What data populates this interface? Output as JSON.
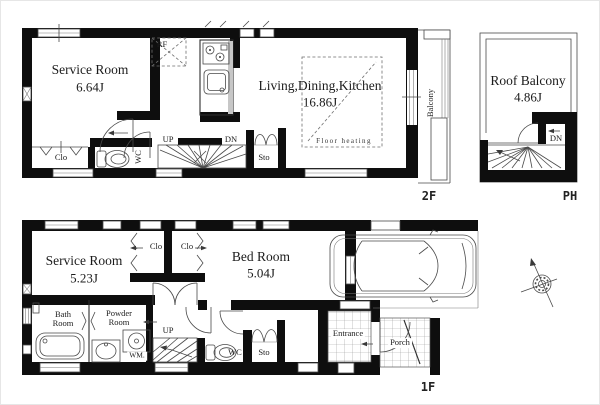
{
  "colors": {
    "wall": "#0e0e0e",
    "line": "#2e2e2e",
    "text": "#1b1b1b",
    "bg": "#ffffff"
  },
  "f2": {
    "floor_label": "2F",
    "service_room": {
      "name": "Service Room",
      "area": "6.64J"
    },
    "ldk": {
      "name": "Living,Dining,Kitchen",
      "area": "16.86J"
    },
    "floor_heating_label": "Floor heating",
    "balcony_label": "Balcony",
    "fridge_label": "RF",
    "closet_label": "Clo",
    "wc_label": "WC",
    "storage_label": "Sto",
    "up_label": "UP",
    "down_label": "DN"
  },
  "ph": {
    "floor_label": "PH",
    "roof_balcony": {
      "name": "Roof Balcony",
      "area": "4.86J"
    },
    "down_label": "DN"
  },
  "f1": {
    "floor_label": "1F",
    "service_room": {
      "name": "Service Room",
      "area": "5.23J"
    },
    "bed_room": {
      "name": "Bed Room",
      "area": "5.04J"
    },
    "closet1_label": "Clo",
    "closet2_label": "Clo",
    "bath_room": {
      "line1": "Bath",
      "line2": "Room"
    },
    "powder_room": {
      "line1": "Powder",
      "line2": "Room"
    },
    "washing_machine_label": "WM.",
    "wc_label": "WC",
    "storage_label": "Sto",
    "up_label": "UP",
    "entrance_label": "Entrance",
    "porch_label": "Porch"
  }
}
